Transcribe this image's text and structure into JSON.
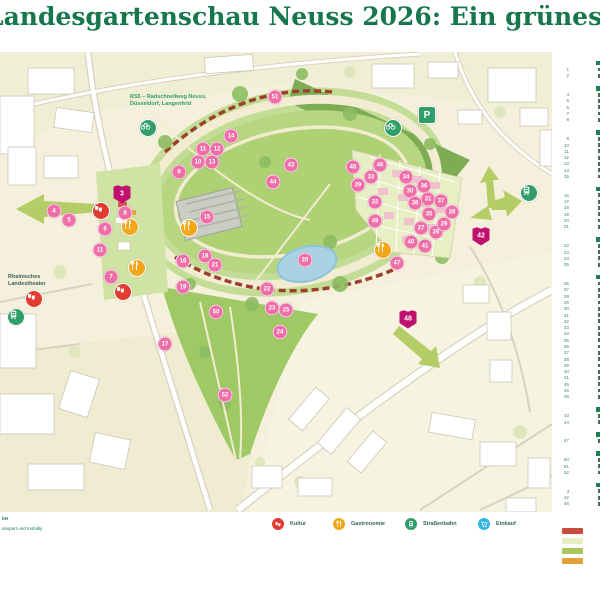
{
  "title": "Landesgartenschau Neuss 2026: Ein grünes Herz in der Stadt",
  "colors": {
    "title_green": "#17774c",
    "marker_pink": "#ee6fa7",
    "shield_magenta": "#c0116e",
    "kultur_red": "#e23b30",
    "gastronomie_orange": "#f2a71b",
    "transit_green": "#2f9e68",
    "einkauf_blue": "#33b5e5",
    "arrow_green": "#b5cd66"
  },
  "map": {
    "labels": {
      "rs5_line1": "RS5 – Radschnellweg Neuss,",
      "rs5_line2": "Düsseldorf, Langenfeld",
      "theater_line1": "Rheinisches",
      "theater_line2": "Landestheater"
    },
    "markers": {
      "poi": [
        {
          "n": "4",
          "x": 54,
          "y": 159
        },
        {
          "n": "5",
          "x": 69,
          "y": 168
        },
        {
          "n": "6",
          "x": 105,
          "y": 177
        },
        {
          "n": "7",
          "x": 111,
          "y": 225
        },
        {
          "n": "8",
          "x": 125,
          "y": 161
        },
        {
          "n": "9",
          "x": 179,
          "y": 120
        },
        {
          "n": "10",
          "x": 198,
          "y": 110
        },
        {
          "n": "11",
          "x": 203,
          "y": 97
        },
        {
          "n": "12",
          "x": 217,
          "y": 97
        },
        {
          "n": "13",
          "x": 212,
          "y": 110
        },
        {
          "n": "14",
          "x": 231,
          "y": 84
        },
        {
          "n": "15",
          "x": 207,
          "y": 165
        },
        {
          "n": "16",
          "x": 183,
          "y": 209
        },
        {
          "n": "17",
          "x": 165,
          "y": 292
        },
        {
          "n": "18",
          "x": 205,
          "y": 204
        },
        {
          "n": "19",
          "x": 183,
          "y": 235
        },
        {
          "n": "20",
          "x": 305,
          "y": 208
        },
        {
          "n": "21",
          "x": 215,
          "y": 213
        },
        {
          "n": "22",
          "x": 267,
          "y": 237
        },
        {
          "n": "23",
          "x": 272,
          "y": 256
        },
        {
          "n": "24",
          "x": 280,
          "y": 280
        },
        {
          "n": "25",
          "x": 286,
          "y": 258
        },
        {
          "n": "26",
          "x": 436,
          "y": 180
        },
        {
          "n": "27",
          "x": 421,
          "y": 176
        },
        {
          "n": "28",
          "x": 452,
          "y": 160
        },
        {
          "n": "29",
          "x": 444,
          "y": 172
        },
        {
          "n": "30",
          "x": 410,
          "y": 139
        },
        {
          "n": "31",
          "x": 428,
          "y": 147
        },
        {
          "n": "32",
          "x": 375,
          "y": 150
        },
        {
          "n": "33",
          "x": 371,
          "y": 125
        },
        {
          "n": "34",
          "x": 406,
          "y": 125
        },
        {
          "n": "35",
          "x": 429,
          "y": 162
        },
        {
          "n": "36",
          "x": 424,
          "y": 134
        },
        {
          "n": "37",
          "x": 441,
          "y": 149
        },
        {
          "n": "38",
          "x": 415,
          "y": 151
        },
        {
          "n": "39",
          "x": 358,
          "y": 133
        },
        {
          "n": "40",
          "x": 411,
          "y": 190
        },
        {
          "n": "41",
          "x": 425,
          "y": 194
        },
        {
          "n": "43",
          "x": 291,
          "y": 113
        },
        {
          "n": "44",
          "x": 273,
          "y": 130
        },
        {
          "n": "45",
          "x": 353,
          "y": 115
        },
        {
          "n": "46",
          "x": 380,
          "y": 113
        },
        {
          "n": "47",
          "x": 397,
          "y": 211
        },
        {
          "n": "49",
          "x": 375,
          "y": 169
        },
        {
          "n": "50",
          "x": 216,
          "y": 260
        },
        {
          "n": "51",
          "x": 275,
          "y": 45
        },
        {
          "n": "52",
          "x": 225,
          "y": 343
        },
        {
          "n": "11",
          "x": 100,
          "y": 198
        }
      ],
      "shields": [
        {
          "n": "3",
          "x": 122,
          "y": 142
        },
        {
          "n": "42",
          "x": 481,
          "y": 184
        },
        {
          "n": "48",
          "x": 408,
          "y": 267
        }
      ],
      "services": [
        {
          "icon": "masks-icon",
          "color": "#e23b30",
          "x": 101,
          "y": 159
        },
        {
          "icon": "masks-icon",
          "color": "#e23b30",
          "x": 123,
          "y": 240
        },
        {
          "icon": "masks-icon",
          "color": "#e23b30",
          "x": 34,
          "y": 247
        },
        {
          "icon": "fork-knife-icon",
          "color": "#f2a71b",
          "x": 130,
          "y": 175
        },
        {
          "icon": "fork-knife-icon",
          "color": "#f2a71b",
          "x": 137,
          "y": 216
        },
        {
          "icon": "fork-knife-icon",
          "color": "#f2a71b",
          "x": 189,
          "y": 176
        },
        {
          "icon": "fork-knife-icon",
          "color": "#f2a71b",
          "x": 383,
          "y": 198
        },
        {
          "icon": "tram-icon",
          "color": "#2f9e68",
          "x": 16,
          "y": 265
        },
        {
          "icon": "tram-icon",
          "color": "#2f9e68",
          "x": 529,
          "y": 141
        },
        {
          "icon": "bike-icon",
          "color": "#2f9e68",
          "x": 148,
          "y": 76
        },
        {
          "icon": "bike-icon",
          "color": "#2f9e68",
          "x": 393,
          "y": 76
        },
        {
          "icon": "parking-icon",
          "color": "#2f9e68",
          "x": 427,
          "y": 63,
          "square": true
        }
      ]
    },
    "arrows": [
      "west-exit",
      "north-east-exit",
      "south-east-exit"
    ]
  },
  "legend": {
    "items": [
      {
        "label": "Kultur",
        "color": "#e23b30",
        "icon": "masks-icon",
        "x": 272
      },
      {
        "label": "Gastronomie",
        "color": "#f2a71b",
        "icon": "fork-knife-icon",
        "x": 333
      },
      {
        "label": "Straßenbahn",
        "color": "#2f9e68",
        "icon": "tram-icon",
        "x": 405
      },
      {
        "label": "Einkauf",
        "color": "#33b5e5",
        "icon": "cart-icon",
        "x": 478
      }
    ]
  },
  "credits": {
    "line1": "bH",
    "line2": "ansport und mobility"
  },
  "right_list": {
    "groups": [
      {
        "items": [
          "1",
          "2"
        ]
      },
      {
        "items": [
          "4",
          "5",
          "6",
          "7",
          "8"
        ]
      },
      {
        "items": [
          "9",
          "10",
          "11",
          "12",
          "13",
          "14",
          "15"
        ]
      },
      {
        "items": [
          "16",
          "17",
          "18",
          "19",
          "20",
          "21"
        ]
      },
      {
        "items": [
          "22",
          "23",
          "24",
          "25"
        ]
      },
      {
        "items": [
          "26",
          "27",
          "28",
          "29",
          "30",
          "31",
          "32",
          "33",
          "34",
          "35",
          "36",
          "37",
          "38",
          "39",
          "40",
          "41",
          "45",
          "46",
          "49"
        ]
      },
      {
        "items": [
          "43",
          "44"
        ]
      },
      {
        "items": [
          "47"
        ]
      },
      {
        "items": [
          "50",
          "51",
          "52"
        ]
      },
      {
        "items": [
          "3",
          "42",
          "48"
        ]
      }
    ],
    "swatches": [
      "#c94b40",
      "#e9edc4",
      "#a9c75f",
      "#e3a13b"
    ]
  }
}
